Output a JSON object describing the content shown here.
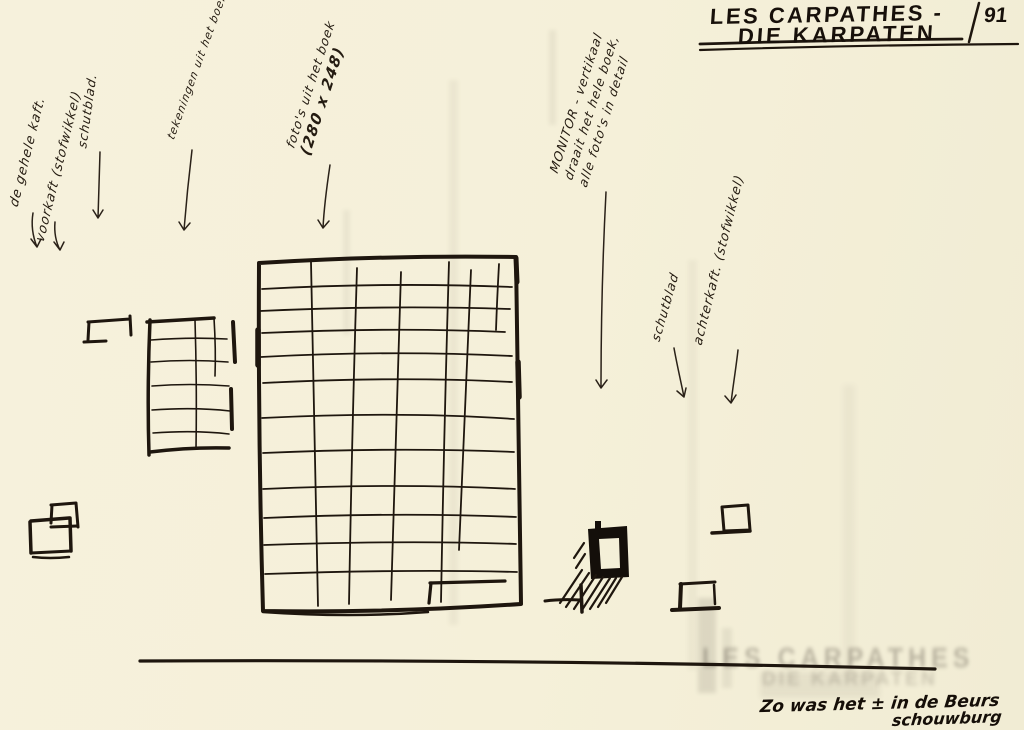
{
  "page": {
    "title_line1": "LES CARPATHES -",
    "title_line2": "DIE KARPATEN",
    "page_number": "91"
  },
  "annotations": {
    "whole_cover": "de gehele kaft.",
    "front_cover": "voorkaft (stofwikkel)",
    "endpaper_left": "schutblad.",
    "drawings_from_book": "tekeningen uit het boek",
    "photos_from_book": "foto's uit het boek",
    "photos_size": "(280 x 248)",
    "monitor_line1": "MONITOR - vertikaal",
    "monitor_line2": "draait het hele boek,",
    "monitor_line3": "alle foto's in detail",
    "endpaper_right": "schutblad",
    "back_cover": "achterkaft. (stofwikkel)"
  },
  "ghost_print": {
    "line1": "LES CARPATHES",
    "line2": "DIE KARPATEN"
  },
  "footer_note": {
    "line1": "Zo was het ± in de Beurs",
    "line2": "schouwburg"
  },
  "colors": {
    "paper": "#f5f0da",
    "ink": "#1e160e"
  }
}
